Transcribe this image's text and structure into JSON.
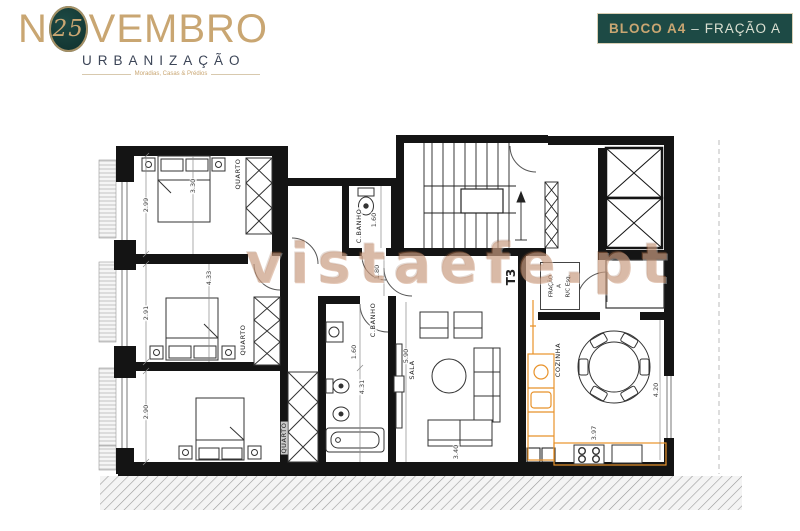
{
  "logo": {
    "name_pre": "N",
    "emblem_number": "25",
    "name_post": "VEMBRO",
    "subtitle": "URBANIZAÇÃO",
    "tagline": "Moradias, Casas & Prédios"
  },
  "badge": {
    "block": "BLOCO A4",
    "separator": "–",
    "fraction": "FRAÇÃO A"
  },
  "watermark": "vistaefe.pt",
  "plan": {
    "rooms": {
      "bedroom1": "QUARTO",
      "bedroom2": "QUARTO",
      "bedroom3": "QUARTO",
      "bathroom_small": "C.BANHO",
      "bathroom_main": "C.BANHO",
      "living": "SALA",
      "kitchen": "COZINHA"
    },
    "unit_box": {
      "line1": "FRAÇÃO",
      "line2": "A",
      "line3": "R/C Esq."
    },
    "type_label": "T3",
    "dimensions": {
      "bedroom1_height": "2.99",
      "bedroom2_height": "2.91",
      "bedroom3_height": "2.90",
      "bedroom1_width": "3.30",
      "bedroom2_width": "4.33",
      "bath_small_width": "1.60",
      "bath_small_depth": "1.80",
      "bath_main_width": "1.60",
      "bath_main_length": "4.31",
      "living_length": "5.90",
      "living_width": "3.40",
      "kitchen_length": "4.20",
      "kitchen_width": "3.97"
    },
    "colors": {
      "wall": "#141414",
      "kitchen_accent": "#e8922a",
      "badge_bg": "#1d4a45",
      "gold": "#c9a672",
      "watermark": "#bf7d55"
    }
  }
}
